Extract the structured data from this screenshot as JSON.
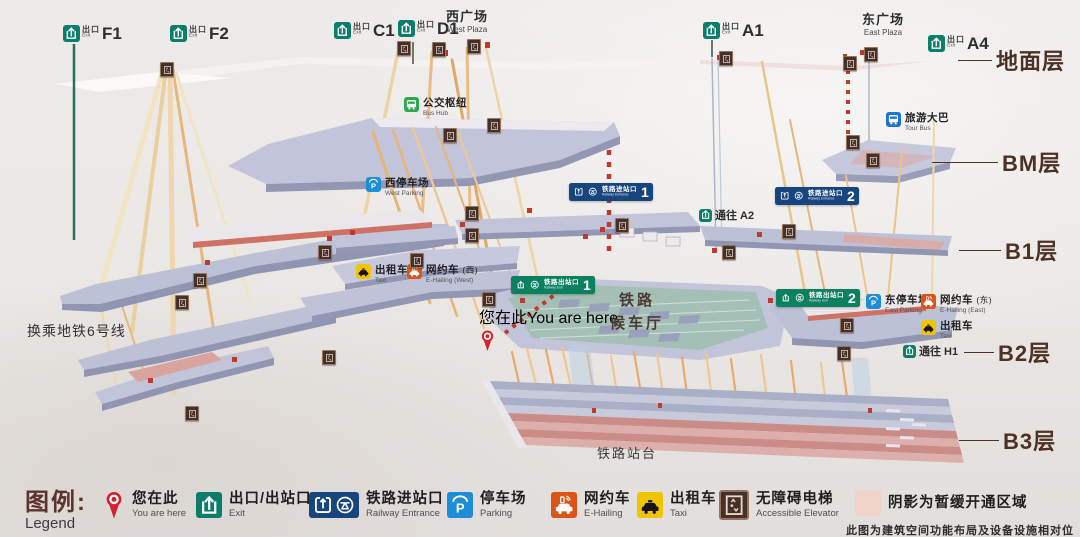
{
  "colors": {
    "exit_green": "#0a7e6b",
    "entrance_blue": "#17457d",
    "exit_sign_green": "#0b8160",
    "parking_blue": "#1c8dd6",
    "taxi_yellow": "#f0c400",
    "ehailing_orange": "#dc5418",
    "bus_green": "#2fa84f",
    "tourbus_blue": "#1d72cc",
    "elevator_brown": "#45302a",
    "pin_red": "#d5212e",
    "floor_text": "#4d3224",
    "shade_pink": "#f1d4c9"
  },
  "map": {
    "floor_labels": [
      {
        "label": "地面层",
        "x": 998,
        "y": 44,
        "lw": 34
      },
      {
        "label": "BM层",
        "x": 1004,
        "y": 146,
        "lw": 66
      },
      {
        "label": "B1层",
        "x": 1007,
        "y": 234,
        "lw": 42
      },
      {
        "label": "B2层",
        "x": 1000,
        "y": 336,
        "lw": 30
      },
      {
        "label": "B3层",
        "x": 1005,
        "y": 424,
        "lw": 40
      }
    ],
    "exit_signs": [
      {
        "label": "F1",
        "cn": "出口",
        "en": "Exit",
        "x": 63,
        "y": 25
      },
      {
        "label": "F2",
        "cn": "出口",
        "en": "Exit",
        "x": 170,
        "y": 25
      },
      {
        "label": "C1",
        "cn": "出口",
        "en": "Exit",
        "x": 334,
        "y": 22
      },
      {
        "label": "D1",
        "cn": "出口",
        "en": "Exit",
        "x": 398,
        "y": 20
      },
      {
        "label": "A1",
        "cn": "出口",
        "en": "Exit",
        "x": 703,
        "y": 22
      },
      {
        "label": "A4",
        "cn": "出口",
        "en": "Exit",
        "x": 928,
        "y": 35
      }
    ],
    "plaza_labels": [
      {
        "cn": "西广场",
        "en": "West Plaza",
        "x": 446,
        "y": 10
      },
      {
        "cn": "东广场",
        "en": "East Plaza",
        "x": 862,
        "y": 13
      }
    ],
    "facilities": [
      {
        "type": "bus",
        "cn": "公交枢纽",
        "en": "Bus Hub",
        "x": 404,
        "y": 97
      },
      {
        "type": "tourbus",
        "cn": "旅游大巴",
        "en": "Tour Bus",
        "x": 886,
        "y": 112
      },
      {
        "type": "parking",
        "cn": "西停车场",
        "en": "West Parking",
        "x": 366,
        "y": 177
      },
      {
        "type": "parking",
        "cn": "东停车场",
        "en": "East Parking",
        "x": 866,
        "y": 294
      },
      {
        "type": "taxi",
        "cn": "出租车",
        "en": "Taxi",
        "x": 356,
        "y": 264
      },
      {
        "type": "ehailing",
        "cn": "网约车",
        "cn2": "(西)",
        "en": "E-Hailing",
        "en2": "(West)",
        "x": 407,
        "y": 264
      },
      {
        "type": "ehailing",
        "cn": "网约车",
        "cn2": "(东)",
        "en": "E-Hailing",
        "en2": "(East)",
        "x": 921,
        "y": 294
      },
      {
        "type": "taxi",
        "cn": "出租车",
        "en": "Taxi",
        "x": 921,
        "y": 320
      }
    ],
    "rail_signs": [
      {
        "kind": "entrance",
        "cn": "铁路进站口",
        "en": "Railway Entrance",
        "num": "1",
        "x": 569,
        "y": 183
      },
      {
        "kind": "entrance",
        "cn": "铁路进站口",
        "en": "Railway Entrance",
        "num": "2",
        "x": 775,
        "y": 187
      },
      {
        "kind": "exit",
        "cn": "铁路出站口",
        "en": "Railway Exit",
        "num": "1",
        "x": 511,
        "y": 276
      },
      {
        "kind": "exit",
        "cn": "铁路出站口",
        "en": "Railway Exit",
        "num": "2",
        "x": 776,
        "y": 289
      }
    ],
    "route_signs": [
      {
        "cn": "通往",
        "label": "A2",
        "x": 699,
        "y": 207
      },
      {
        "cn": "通往",
        "label": "H1",
        "x": 903,
        "y": 343
      }
    ],
    "you_are_here": {
      "cn": "您在此",
      "en": "You are here",
      "x": 479,
      "y": 304
    },
    "area_labels": [
      {
        "cls": "transfer",
        "text": "换乘地铁6号线",
        "x": 27,
        "y": 321
      },
      {
        "cls": "hall",
        "text": "铁路\n候车厅",
        "x": 610,
        "y": 290
      },
      {
        "cls": "platform",
        "text": "铁路站台",
        "x": 597,
        "y": 443
      }
    ],
    "elevator_label": "无障碍电梯",
    "elevators": [
      [
        160,
        62
      ],
      [
        397,
        41
      ],
      [
        432,
        42
      ],
      [
        467,
        39
      ],
      [
        719,
        51
      ],
      [
        843,
        56
      ],
      [
        864,
        47
      ],
      [
        443,
        128
      ],
      [
        487,
        118
      ],
      [
        846,
        135
      ],
      [
        866,
        153
      ],
      [
        318,
        245
      ],
      [
        465,
        206
      ],
      [
        465,
        228
      ],
      [
        410,
        253
      ],
      [
        615,
        218
      ],
      [
        722,
        245
      ],
      [
        782,
        224
      ],
      [
        193,
        273
      ],
      [
        175,
        295
      ],
      [
        840,
        318
      ],
      [
        837,
        346
      ],
      [
        322,
        350
      ],
      [
        482,
        292
      ],
      [
        185,
        406
      ]
    ]
  },
  "legend": {
    "title_cn": "图例:",
    "title_en": "Legend",
    "x": 25,
    "y": 8,
    "items": [
      {
        "type": "pin",
        "cn": "您在此",
        "en": "You are here",
        "x": 103
      },
      {
        "type": "exit",
        "cn": "出口/出站口",
        "en": "Exit",
        "x": 196
      },
      {
        "type": "entrance",
        "cn": "铁路进站口",
        "en": "Railway Entrance",
        "x": 309
      },
      {
        "type": "parking",
        "cn": "停车场",
        "en": "Parking",
        "x": 447
      },
      {
        "type": "ehailing",
        "cn": "网约车",
        "en": "E-Hailing",
        "x": 551
      },
      {
        "type": "taxi",
        "cn": "出租车",
        "en": "Taxi",
        "x": 637
      },
      {
        "type": "elevator",
        "cn": "无障碍电梯",
        "en": "Accessible Elevator",
        "x": 719
      },
      {
        "type": "shade",
        "cn": "阴影为暂缓开通区域",
        "en": "",
        "x": 855
      }
    ],
    "note": "此图为建筑空间功能布局及设备设施相对位置示意"
  }
}
